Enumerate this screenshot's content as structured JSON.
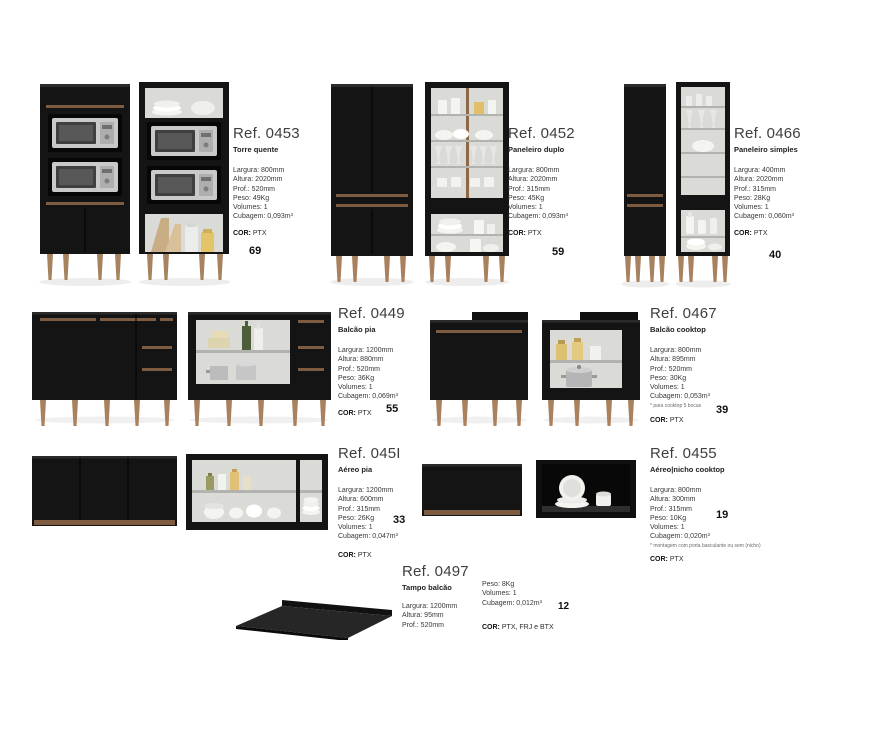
{
  "products": [
    {
      "ref": "Ref. 0453",
      "title": "Torre quente",
      "specs": [
        "Largura: 800mm",
        "Altura: 2020mm",
        "Prof.: 520mm",
        "Peso: 49Kg",
        "Volumes: 1",
        "Cubagem: 0,093m³"
      ],
      "cor_label": "COR:",
      "cor_value": "PTX",
      "number": "69"
    },
    {
      "ref": "Ref. 0452",
      "title": "Paneleiro duplo",
      "specs": [
        "Largura: 800mm",
        "Altura: 2020mm",
        "Prof.: 315mm",
        "Peso: 45Kg",
        "Volumes: 1",
        "Cubagem: 0,093m³"
      ],
      "cor_label": "COR:",
      "cor_value": "PTX",
      "number": "59"
    },
    {
      "ref": "Ref. 0466",
      "title": "Paneleiro simples",
      "specs": [
        "Largura: 400mm",
        "Altura: 2020mm",
        "Prof.: 315mm",
        "Peso: 28Kg",
        "Volumes: 1",
        "Cubagem: 0,060m³"
      ],
      "cor_label": "COR:",
      "cor_value": "PTX",
      "number": "40"
    },
    {
      "ref": "Ref. 0449",
      "title": "Balcão pia",
      "specs": [
        "Largura: 1200mm",
        "Altura: 880mm",
        "Prof.: 520mm",
        "Peso: 36Kg",
        "Volumes: 1",
        "Cubagem: 0,069m³"
      ],
      "cor_label": "COR:",
      "cor_value": "PTX",
      "number": "55"
    },
    {
      "ref": "Ref. 0467",
      "title": "Balcão cooktop",
      "specs": [
        "Largura: 800mm",
        "Altura: 895mm",
        "Prof.: 520mm",
        "Peso: 30Kg",
        "Volumes: 1",
        "Cubagem: 0,053m³"
      ],
      "footnote": "* para cooktop 5 bocas",
      "cor_label": "COR:",
      "cor_value": "PTX",
      "number": "39"
    },
    {
      "ref": "Ref. 045I",
      "title": "Aéreo pia",
      "specs": [
        "Largura: 1200mm",
        "Altura: 600mm",
        "Prof.: 315mm",
        "Peso: 26Kg",
        "Volumes: 1",
        "Cubagem: 0,047m³"
      ],
      "cor_label": "COR:",
      "cor_value": "PTX",
      "number": "33"
    },
    {
      "ref": "Ref. 0455",
      "title": "Aéreo|nicho cooktop",
      "specs": [
        "Largura: 800mm",
        "Altura: 300mm",
        "Prof.: 315mm",
        "Peso: 10Kg",
        "Volumes: 1",
        "Cubagem: 0,020m³"
      ],
      "footnote": "* montagem com porta basculante ou sem (nicho)",
      "cor_label": "COR:",
      "cor_value": "PTX",
      "number": "19"
    },
    {
      "ref": "Ref. 0497",
      "title": "Tampo balcão",
      "specs_left": [
        "Largura: 1200mm",
        "Altura: 95mm",
        "Prof.: 520mm"
      ],
      "specs_right": [
        "Peso: 8Kg",
        "Volumes: 1",
        "Cubagem: 0,012m³"
      ],
      "cor_label": "COR:",
      "cor_value": "PTX, FRJ e BTX",
      "number": "12"
    }
  ],
  "colors": {
    "cabinet_black": "#141414",
    "wood_accent": "#7d5c41",
    "leg_wood": "#a8825e",
    "interior_gray": "#dadad6"
  }
}
